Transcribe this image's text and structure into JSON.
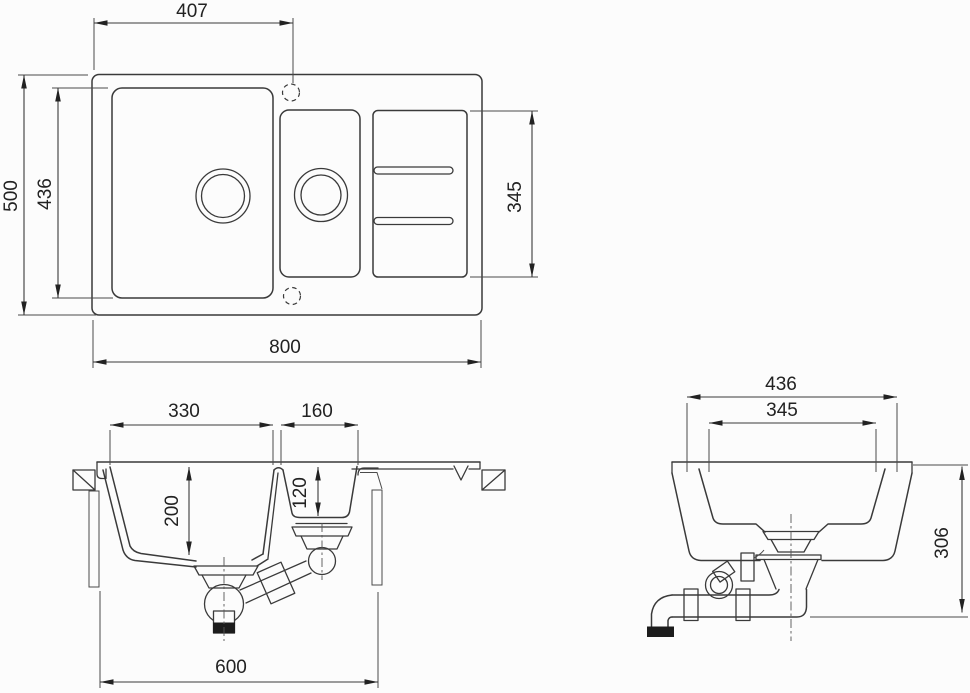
{
  "title": "Kitchen sink technical dimension drawing",
  "colors": {
    "line": "#3a3a3a",
    "background": "#fcfcfc",
    "fill_black": "#1c1c1c"
  },
  "views": {
    "top": {
      "name": "top-view",
      "dims": {
        "tap_hole_offset": "407",
        "overall_depth": "500",
        "bowl_length": "436",
        "drainboard_length": "345",
        "overall_width": "800"
      }
    },
    "front": {
      "name": "front-section-view",
      "dims": {
        "main_bowl_width": "330",
        "half_bowl_width": "160",
        "main_bowl_depth": "200",
        "half_bowl_depth": "120",
        "cabinet_width": "600"
      }
    },
    "side": {
      "name": "side-section-view",
      "dims": {
        "rim_length": "436",
        "bowl_length": "345",
        "install_height": "306"
      }
    }
  }
}
